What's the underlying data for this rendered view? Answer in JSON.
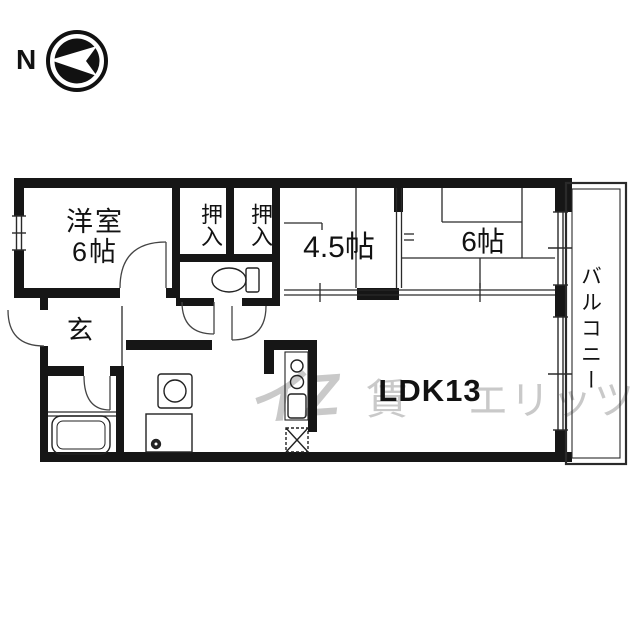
{
  "compass": {
    "north_label": "N"
  },
  "plan": {
    "rooms": {
      "western_line1": "洋室",
      "western_line2": "6帖",
      "closet1": "押入",
      "closet2": "押入",
      "mid_room": "4.5帖",
      "tatami_room": "6帖",
      "entrance": "玄",
      "ldk": "LDK13",
      "balcony": "バルコニー"
    },
    "watermark": {
      "logo": "イZ",
      "left_fragment": "賃",
      "right_fragment": "エリッツ"
    },
    "colors": {
      "wall": "#161616",
      "line": "#2a2a2a",
      "fixture": "#222222",
      "watermark": "#c9c9c9",
      "background": "#ffffff"
    },
    "fixtures": [
      "toilet",
      "bathtub",
      "washbasin",
      "washer-pan",
      "stove-burners",
      "kitchen-sink",
      "refrigerator"
    ]
  }
}
